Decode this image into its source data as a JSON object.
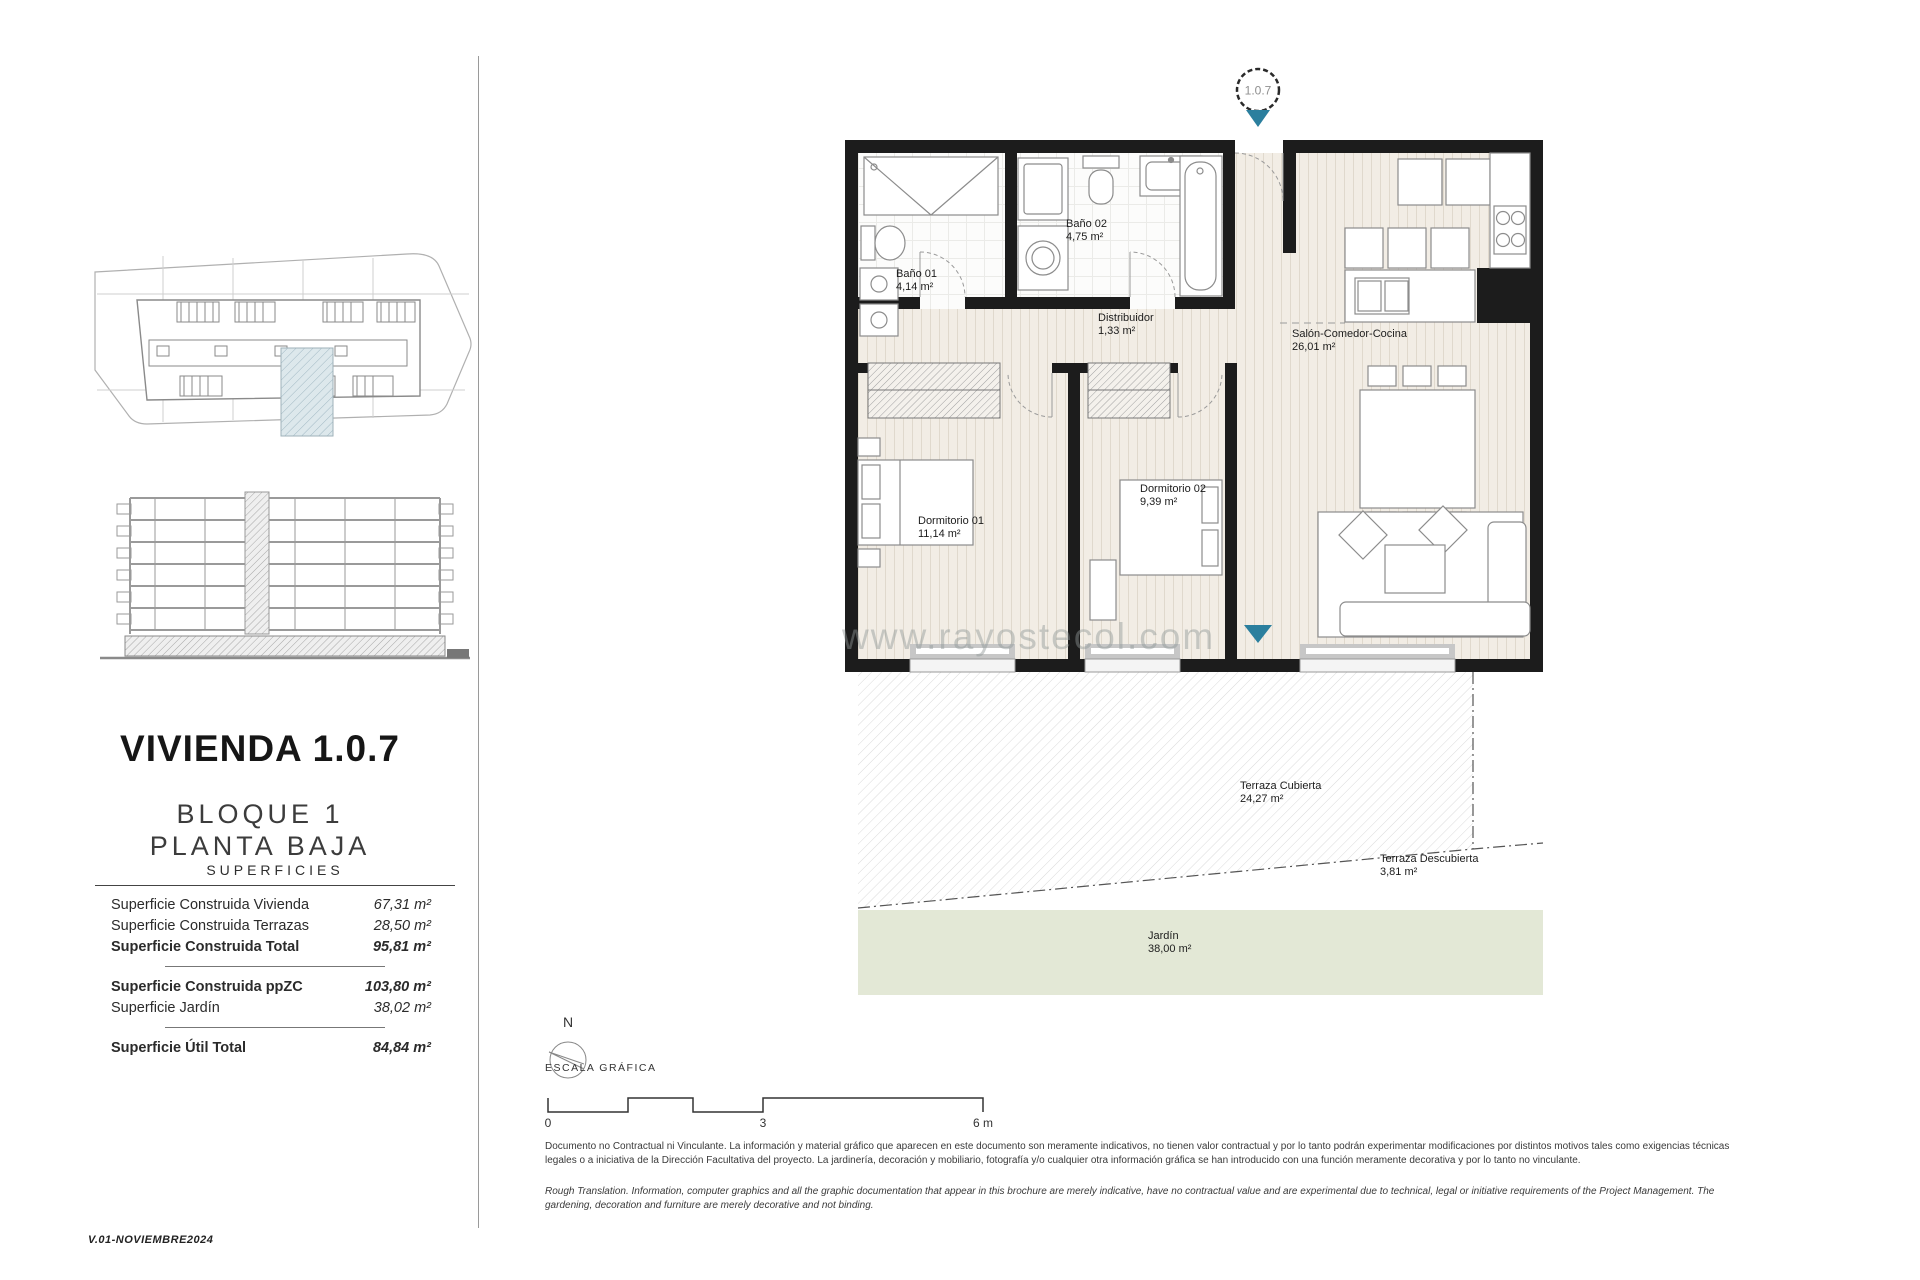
{
  "page": {
    "version": "V.01-NOVIEMBRE2024",
    "watermark": "www.rayostecol.com"
  },
  "info_panel": {
    "title": "VIVIENDA 1.0.7",
    "subtitle_line1": "BLOQUE 1",
    "subtitle_line2": "PLANTA BAJA",
    "superficies": {
      "heading": "SUPERFICIES",
      "rows": [
        {
          "label": "Superficie Construida Vivienda",
          "value": "67,31 m²"
        },
        {
          "label": "Superficie Construida Terrazas",
          "value": "28,50 m²"
        },
        {
          "label": "Superficie Construida Total",
          "value": "95,81 m²"
        },
        {
          "label": "Superficie Construida ppZC",
          "value": "103,80 m²"
        },
        {
          "label": "Superficie Jardín",
          "value": "38,02 m²"
        },
        {
          "label": "Superficie Útil Total",
          "value": "84,84 m²"
        }
      ]
    }
  },
  "plan": {
    "unit_marker": "1.0.7",
    "rooms": [
      {
        "name": "Baño 01",
        "area": "4,14 m²"
      },
      {
        "name": "Baño 02",
        "area": "4,75 m²"
      },
      {
        "name": "Distribuidor",
        "area": "1,33 m²"
      },
      {
        "name": "Salón-Comedor-Cocina",
        "area": "26,01 m²"
      },
      {
        "name": "Dormitorio 01",
        "area": "11,14 m²"
      },
      {
        "name": "Dormitorio 02",
        "area": "9,39 m²"
      },
      {
        "name": "Terraza Cubierta",
        "area": "24,27 m²"
      },
      {
        "name": "Terraza Descubierta",
        "area": "3,81 m²"
      },
      {
        "name": "Jardín",
        "area": "38,00 m²"
      }
    ],
    "north_label": "N",
    "scale_bar": {
      "label": "ESCALA GRÁFICA",
      "tick_0": "0",
      "tick_3": "3",
      "tick_6": "6 m"
    }
  },
  "disclaimer": {
    "spanish": "Documento no Contractual ni Vinculante. La información y material gráfico que aparecen en este documento son meramente indicativos, no tienen valor contractual y por lo tanto podrán experimentar modificaciones por distintos motivos tales como exigencias técnicas legales o a iniciativa de la Dirección Facultativa del proyecto. La jardinería, decoración y mobiliario, fotografía y/o cualquier otra información gráfica se han introducido con una función meramente decorativa y por lo tanto no vinculante.",
    "english": "Rough Translation. Information, computer graphics and all the graphic documentation that appear in this brochure are merely indicative, have no contractual value and are experimental due to technical, legal or initiative requirements of the Project Management. The gardening, decoration and furniture are merely decorative and not binding."
  },
  "colors": {
    "accent_teal": "#2b7f9e",
    "wall_black": "#1c1c1c",
    "floor_beige": "#f2ede5",
    "garden_green": "#e3e8d6"
  }
}
